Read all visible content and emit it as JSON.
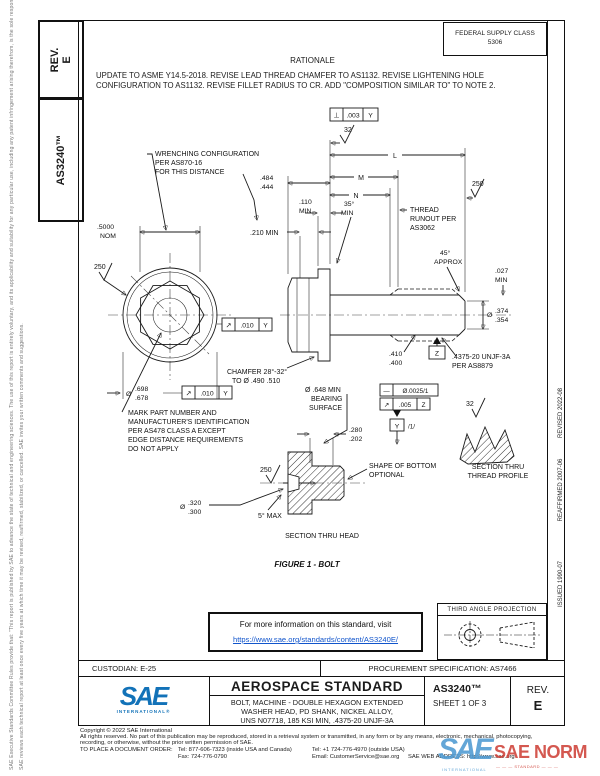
{
  "page": {
    "left_margin_line1": "SAE Executive Standards Committee Rules provide that: \"This report is published by SAE to advance the state of technical and engineering sciences. The use of this report is entirely voluntary, and its applicability and suitability for any particular use, including any patent infringement arising therefrom, is the sole responsibility of the user.\"",
    "left_margin_line2": "SAE reviews each technical report at least once every five years at which time it may be revised, reaffirmed, stabilized, or cancelled. SAE invites your written comments and suggestions.",
    "rev_label": "REV.",
    "rev_value": "E",
    "doc_number": "AS3240™",
    "dates": [
      "REVISED 2022-08",
      "REAFFIRMED 2007-06",
      "ISSUED 1990-07"
    ]
  },
  "header": {
    "fsc_label": "FEDERAL SUPPLY CLASS",
    "fsc_value": "5306",
    "rationale_title": "RATIONALE",
    "rationale_text": "UPDATE TO ASME Y14.5-2018. REVISE LEAD THREAD CHAMFER TO AS1132. REVISE LIGHTENING HOLE CONFIGURATION TO AS1132. REVISE FILLET RADIUS TO CR. ADD \"COMPOSITION SIMILAR TO\" TO NOTE 2."
  },
  "figure": {
    "fcf_top": {
      "sym": "⊥",
      "tol": ".003",
      "datum": "Y"
    },
    "finish_top": "32",
    "wrenching_note": [
      "WRENCHING CONFIGURATION",
      "PER AS870-16",
      "FOR THIS DISTANCE"
    ],
    "dim_L": "L",
    "dim_M": "M",
    "dim_N": "N",
    "dim_head_height": [
      ".484",
      ".444"
    ],
    "dim_110": [
      ".110",
      "MIN"
    ],
    "angle_35": [
      "35°",
      "MIN"
    ],
    "finish_250_shank": "250",
    "dim_5000": [
      ".5000",
      "NOM"
    ],
    "dim_210": ".210 MIN",
    "runout_note": [
      "THREAD",
      "RUNOUT PER",
      "AS3062"
    ],
    "angle_45": [
      "45°",
      "APPROX"
    ],
    "dim_027": [
      ".027",
      "MIN"
    ],
    "finish_250_head": "250",
    "fcf_head_runout": {
      "sym": "↗",
      "tol": ".010",
      "datum": "Y"
    },
    "dim_thread_od": {
      "dia": "Ø",
      "vals": [
        ".374",
        ".354"
      ]
    },
    "chamfer_note": [
      "CHAMFER 28°-32°",
      "TO Ø .490 .510"
    ],
    "dim_flange_od": {
      "dia": "Ø",
      "vals": [
        ".698",
        ".678"
      ]
    },
    "fcf_flange": {
      "sym": "↗",
      "tol": ".010",
      "datum": "Y"
    },
    "mark_note": [
      "MARK PART NUMBER AND",
      "MANUFACTURER'S IDENTIFICATION",
      "PER AS478 CLASS A EXCEPT",
      "EDGE DISTANCE REQUIREMENTS",
      "DO NOT APPLY"
    ],
    "dim_pd": [
      ".410",
      ".400"
    ],
    "thread_spec": [
      ".4375-20 UNJF-3A",
      "PER AS8879"
    ],
    "datum_z": "Z",
    "bearing_note": [
      "Ø .648 MIN",
      "BEARING",
      "SURFACE"
    ],
    "fcf_straight": {
      "sym": "—",
      "tol": "Ø.0025/1"
    },
    "fcf_bearing": {
      "sym": "↗",
      "tol": ".005",
      "datum": "Z"
    },
    "datum_y": "Y",
    "datum_y_note": "/1/",
    "dim_280": [
      ".280",
      ".202"
    ],
    "bottom_note": [
      "SHAPE OF BOTTOM",
      "OPTIONAL"
    ],
    "finish_250_section": "250",
    "dim_320": {
      "dia": "Ø",
      "vals": [
        ".320",
        ".300"
      ]
    },
    "angle_5": "5° MAX",
    "section_head_label": "SECTION THRU HEAD",
    "caption": "FIGURE 1 - BOLT",
    "finish_32_thread": "32",
    "section_thread_label": [
      "SECTION THRU",
      "THREAD PROFILE"
    ]
  },
  "info_box": {
    "line1": "For more information on this standard, visit",
    "link": "https://www.sae.org/standards/content/AS3240E/"
  },
  "projection": {
    "label": "THIRD ANGLE PROJECTION"
  },
  "title_block": {
    "custodian": "CUSTODIAN: E-25",
    "procurement": "PROCUREMENT SPECIFICATION: AS7466",
    "logo_text": "SAE",
    "logo_sub": "INTERNATIONAL®",
    "doc_type": "AEROSPACE STANDARD",
    "title_line1": "BOLT, MACHINE - DOUBLE HEXAGON EXTENDED",
    "title_line2": "WASHER HEAD, PD SHANK, NICKEL ALLOY,",
    "title_line3": "UNS N07718, 185 KSI MIN, .4375-20 UNJF-3A",
    "doc_number": "AS3240™",
    "sheet": "SHEET 1 OF 3",
    "rev_label": "REV.",
    "rev_value": "E"
  },
  "footer": {
    "copyright": "Copyright © 2022 SAE International",
    "rights_line1": "All rights reserved. No part of this publication may be reproduced, stored in a retrieval system or transmitted, in any form or by any means, electronic, mechanical, photocopying,",
    "rights_line2": "recording, or otherwise, without the prior written permission of SAE.",
    "order_label": "TO PLACE A DOCUMENT ORDER:",
    "tel_usa": "Tel: 877-606-7323 (inside USA and Canada)",
    "tel_outside": "Tel: +1 724-776-4970 (outside USA)",
    "fax": "Fax: 724-776-0790",
    "email": "Email: CustomerService@sae.org",
    "web": "SAE WEB ADDRESS: http://www.sae.org"
  },
  "watermark": {
    "logo": "SAE",
    "name": "SAE NORM",
    "sub1": "INTERNATIONAL",
    "sub2": "— — — STANDARD — — —"
  }
}
